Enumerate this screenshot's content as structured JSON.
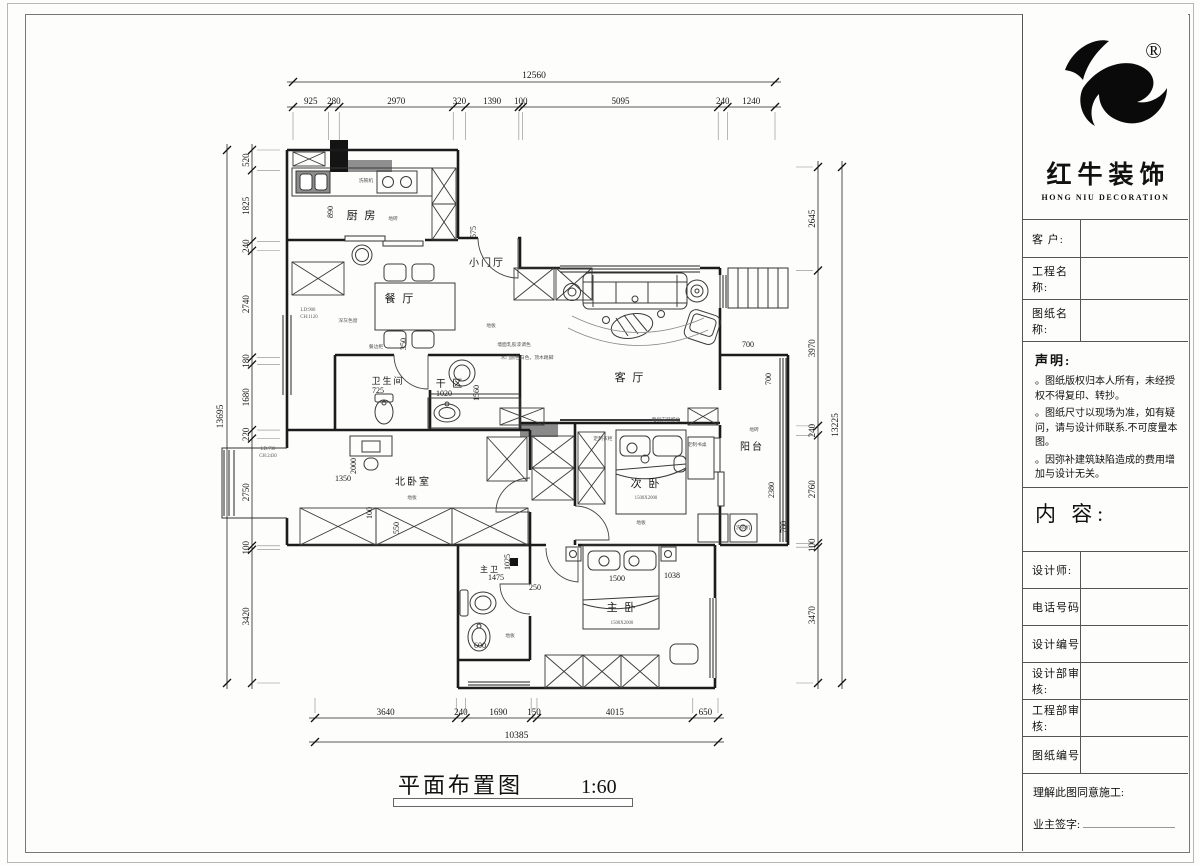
{
  "page": {
    "title": "平面布置图",
    "scale": "1:60"
  },
  "title_block": {
    "brand": {
      "cn": "红牛装饰",
      "en": "HONG NIU DECORATION",
      "registered": "®"
    },
    "fields": [
      {
        "label": "客  户:"
      },
      {
        "label": "工程名称:"
      },
      {
        "label": "图纸名称:"
      }
    ],
    "statement": {
      "title": "声明:",
      "items": [
        "。图纸版权归本人所有，未经授权不得复印、转抄。",
        "。图纸尺寸以现场为准，如有疑问，请与设计师联系.不可度量本图。",
        "。因弥补建筑缺陷造成的费用增加与设计无关。"
      ]
    },
    "content_label": "内 容:",
    "rows": [
      {
        "label": "设计师:"
      },
      {
        "label": "电话号码"
      },
      {
        "label": "设计编号"
      },
      {
        "label": "设计部审核:"
      },
      {
        "label": "工程部审核:"
      },
      {
        "label": "图纸编号"
      }
    ],
    "footer": {
      "line1": "理解此图同意施工:",
      "line2": "业主签字:"
    }
  },
  "floor_plan": {
    "dims": {
      "top": {
        "total": "12560",
        "segments": [
          "925",
          "280",
          "2970",
          "320",
          "1390",
          "100",
          "5095",
          "240",
          "1240"
        ]
      },
      "left": {
        "total": "13695",
        "segments": [
          "520",
          "1825",
          "240",
          "2740",
          "180",
          "1680",
          "220",
          "2750",
          "100",
          "3420"
        ]
      },
      "right": {
        "total": "13225",
        "segments": [
          "2645",
          "3970",
          "240",
          "2760",
          "100",
          "3470"
        ]
      },
      "bottom": {
        "total": "10385",
        "segments": [
          "3640",
          "240",
          "1690",
          "150",
          "4015",
          "650"
        ]
      }
    },
    "rooms": [
      {
        "t": "厨 房",
        "x": 362,
        "y": 219,
        "s": 11
      },
      {
        "t": "小门厅",
        "x": 487,
        "y": 266,
        "s": 10
      },
      {
        "t": "餐 厅",
        "x": 400,
        "y": 302,
        "s": 11
      },
      {
        "t": "客 厅",
        "x": 630,
        "y": 381,
        "s": 11
      },
      {
        "t": "卫生间",
        "x": 388,
        "y": 384,
        "s": 9
      },
      {
        "t": "干 区",
        "x": 450,
        "y": 387,
        "s": 10
      },
      {
        "t": "北卧室",
        "x": 413,
        "y": 485,
        "s": 10
      },
      {
        "t": "次 卧",
        "x": 646,
        "y": 487,
        "s": 11
      },
      {
        "t": "阳台",
        "x": 752,
        "y": 450,
        "s": 10
      },
      {
        "t": "主 卧",
        "x": 622,
        "y": 611,
        "s": 11
      },
      {
        "t": "主卫",
        "x": 490,
        "y": 572,
        "s": 8
      }
    ],
    "interior_dims": [
      {
        "t": "890",
        "x": 333,
        "y": 212,
        "r": -90
      },
      {
        "t": "575",
        "x": 476,
        "y": 232,
        "r": -90
      },
      {
        "t": "350",
        "x": 406,
        "y": 344,
        "r": -90
      },
      {
        "t": "725",
        "x": 378,
        "y": 393
      },
      {
        "t": "1020",
        "x": 444,
        "y": 396
      },
      {
        "t": "1560",
        "x": 479,
        "y": 393,
        "r": -90
      },
      {
        "t": "1350",
        "x": 343,
        "y": 481
      },
      {
        "t": "2000",
        "x": 356,
        "y": 466,
        "r": -90
      },
      {
        "t": "100",
        "x": 372,
        "y": 513,
        "r": -90
      },
      {
        "t": "550",
        "x": 399,
        "y": 528,
        "r": -90
      },
      {
        "t": "700",
        "x": 748,
        "y": 347
      },
      {
        "t": "700",
        "x": 771,
        "y": 379,
        "r": -90
      },
      {
        "t": "2380",
        "x": 774,
        "y": 490,
        "r": -90
      },
      {
        "t": "780",
        "x": 786,
        "y": 527,
        "r": -90
      },
      {
        "t": "1475",
        "x": 496,
        "y": 580
      },
      {
        "t": "1025",
        "x": 510,
        "y": 562,
        "r": -90
      },
      {
        "t": "250",
        "x": 535,
        "y": 590
      },
      {
        "t": "600",
        "x": 480,
        "y": 648
      },
      {
        "t": "1500",
        "x": 617,
        "y": 581
      },
      {
        "t": "1038",
        "x": 672,
        "y": 578
      }
    ],
    "annotations": [
      {
        "t": "地砖",
        "x": 393,
        "y": 220
      },
      {
        "t": "洗碗机",
        "x": 366,
        "y": 182
      },
      {
        "t": "LD:900",
        "x": 308,
        "y": 311
      },
      {
        "t": "CH:1120",
        "x": 309,
        "y": 318
      },
      {
        "t": "深灰色窗",
        "x": 348,
        "y": 322
      },
      {
        "t": "餐边柜",
        "x": 376,
        "y": 348
      },
      {
        "t": "地板",
        "x": 491,
        "y": 327
      },
      {
        "t": "墙面乳胶漆调色",
        "x": 514,
        "y": 346
      },
      {
        "t": "木门颜色白色，顶木踢脚",
        "x": 527,
        "y": 359
      },
      {
        "t": "电视安装留位",
        "x": 666,
        "y": 421
      },
      {
        "t": "地砖",
        "x": 754,
        "y": 431
      },
      {
        "t": "洗衣机",
        "x": 743,
        "y": 529
      },
      {
        "t": "地板",
        "x": 412,
        "y": 499
      },
      {
        "t": "地板",
        "x": 641,
        "y": 524
      },
      {
        "t": "地板",
        "x": 510,
        "y": 637
      },
      {
        "t": "定制书桌",
        "x": 697,
        "y": 446
      },
      {
        "t": "定制衣柜",
        "x": 603,
        "y": 440
      },
      {
        "t": "1500X2000",
        "x": 646,
        "y": 499
      },
      {
        "t": "1500X2000",
        "x": 622,
        "y": 624
      },
      {
        "t": "LD:730",
        "x": 268,
        "y": 450
      },
      {
        "t": "CH:2430",
        "x": 268,
        "y": 457
      }
    ]
  }
}
